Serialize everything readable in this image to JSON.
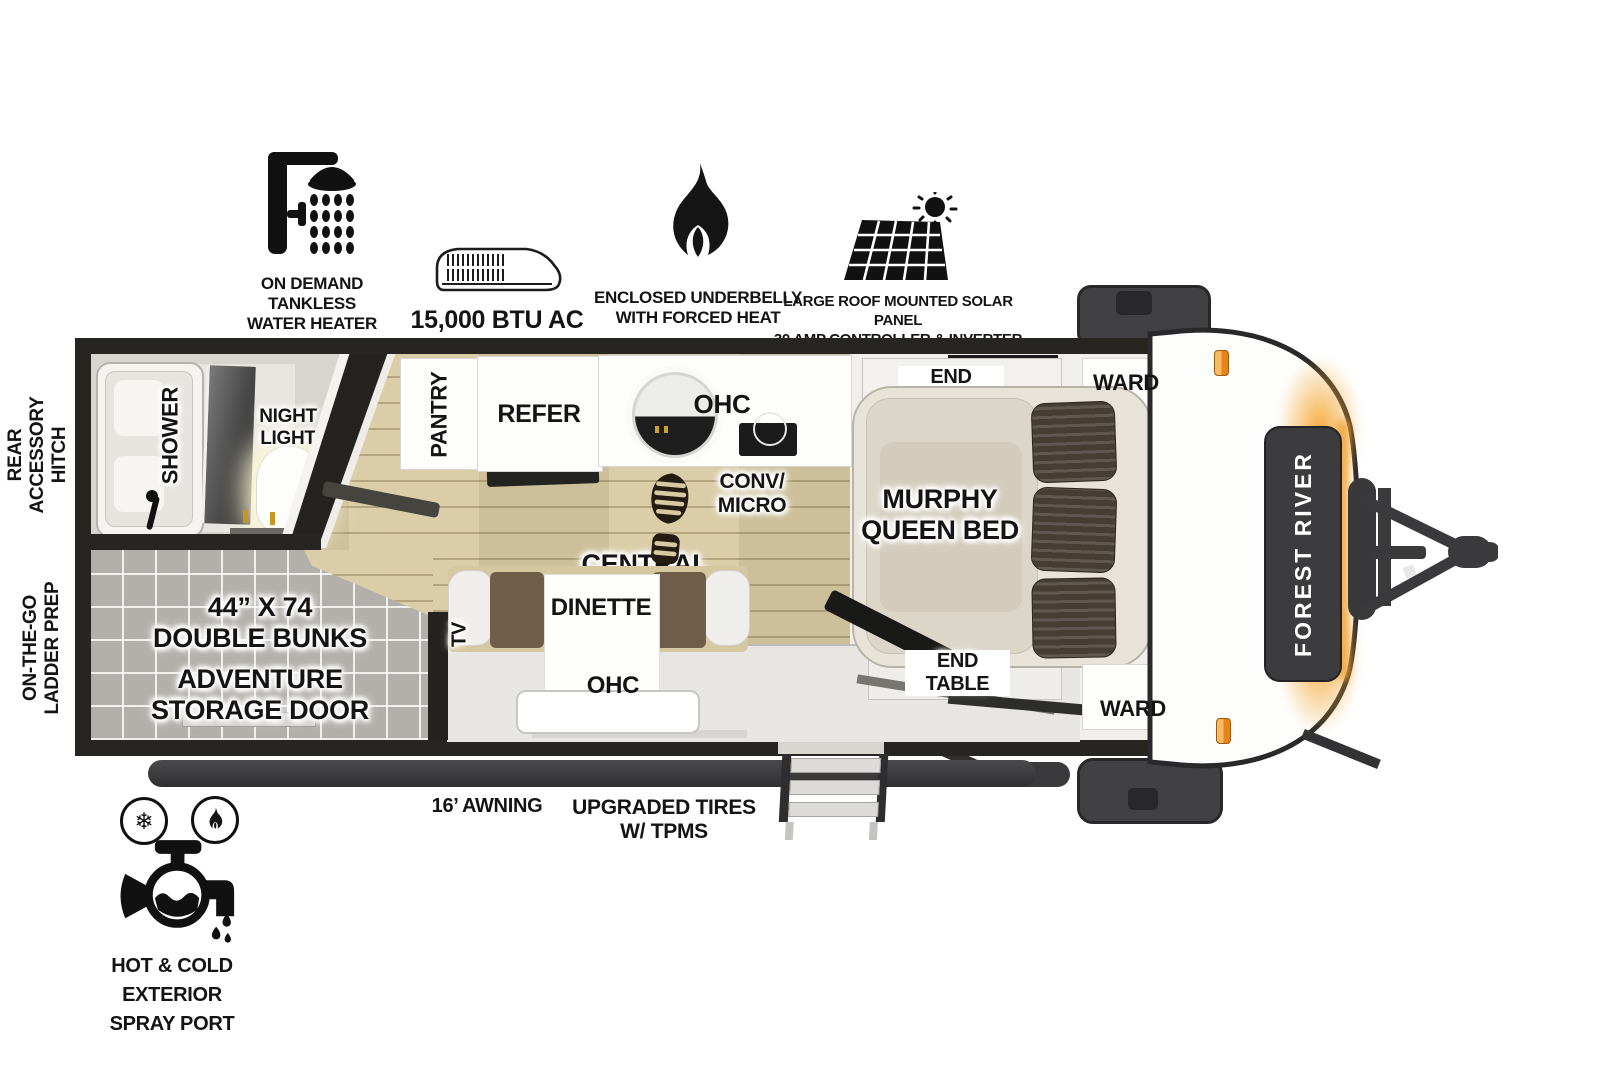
{
  "features": {
    "water_heater": "ON DEMAND\nTANKLESS\nWATER HEATER",
    "ac": "15,000 BTU AC",
    "underbelly": "ENCLOSED UNDERBELLY\nWITH FORCED HEAT",
    "solar": "LARGE ROOF MOUNTED SOLAR PANEL\n30 AMP CONTROLLER & INVERTER PREP"
  },
  "exterior": {
    "rear_hitch": "REAR\nACCESSORY\nHITCH",
    "ladder_prep": "ON-THE-GO\nLADDER PREP",
    "awning": "16’ AWNING",
    "tires": "UPGRADED TIRES\nW/ TPMS",
    "spray_port": "HOT & COLD EXTERIOR\nSPRAY PORT",
    "brand": "FOREST RIVER"
  },
  "rooms": {
    "shower": "SHOWER",
    "night_light": "NIGHT\nLIGHT",
    "pantry": "PANTRY",
    "refer": "REFER",
    "kitchen_ohc": "OHC",
    "conv_micro": "CONV/\nMICRO",
    "central_vac": "CENTRAL\nVAC",
    "murphy_bed": "MURPHY\nQUEEN BED",
    "end_table_top": "END\nTABLE",
    "end_table_bottom": "END\nTABLE",
    "ward_top": "WARD",
    "ward_bottom": "WARD",
    "dinette": "DINETTE",
    "dinette_ohc": "OHC",
    "tv": "TV",
    "bunks": "44” X 74\nDOUBLE BUNKS",
    "storage_door": "ADVENTURE\nSTORAGE DOOR"
  },
  "colors": {
    "wall": "#262522",
    "wood_floor": "#D7C9A1",
    "tile_floor": "#B3B0AB",
    "marker_light": "#E8821B",
    "cap_glow": "#F4A630"
  }
}
